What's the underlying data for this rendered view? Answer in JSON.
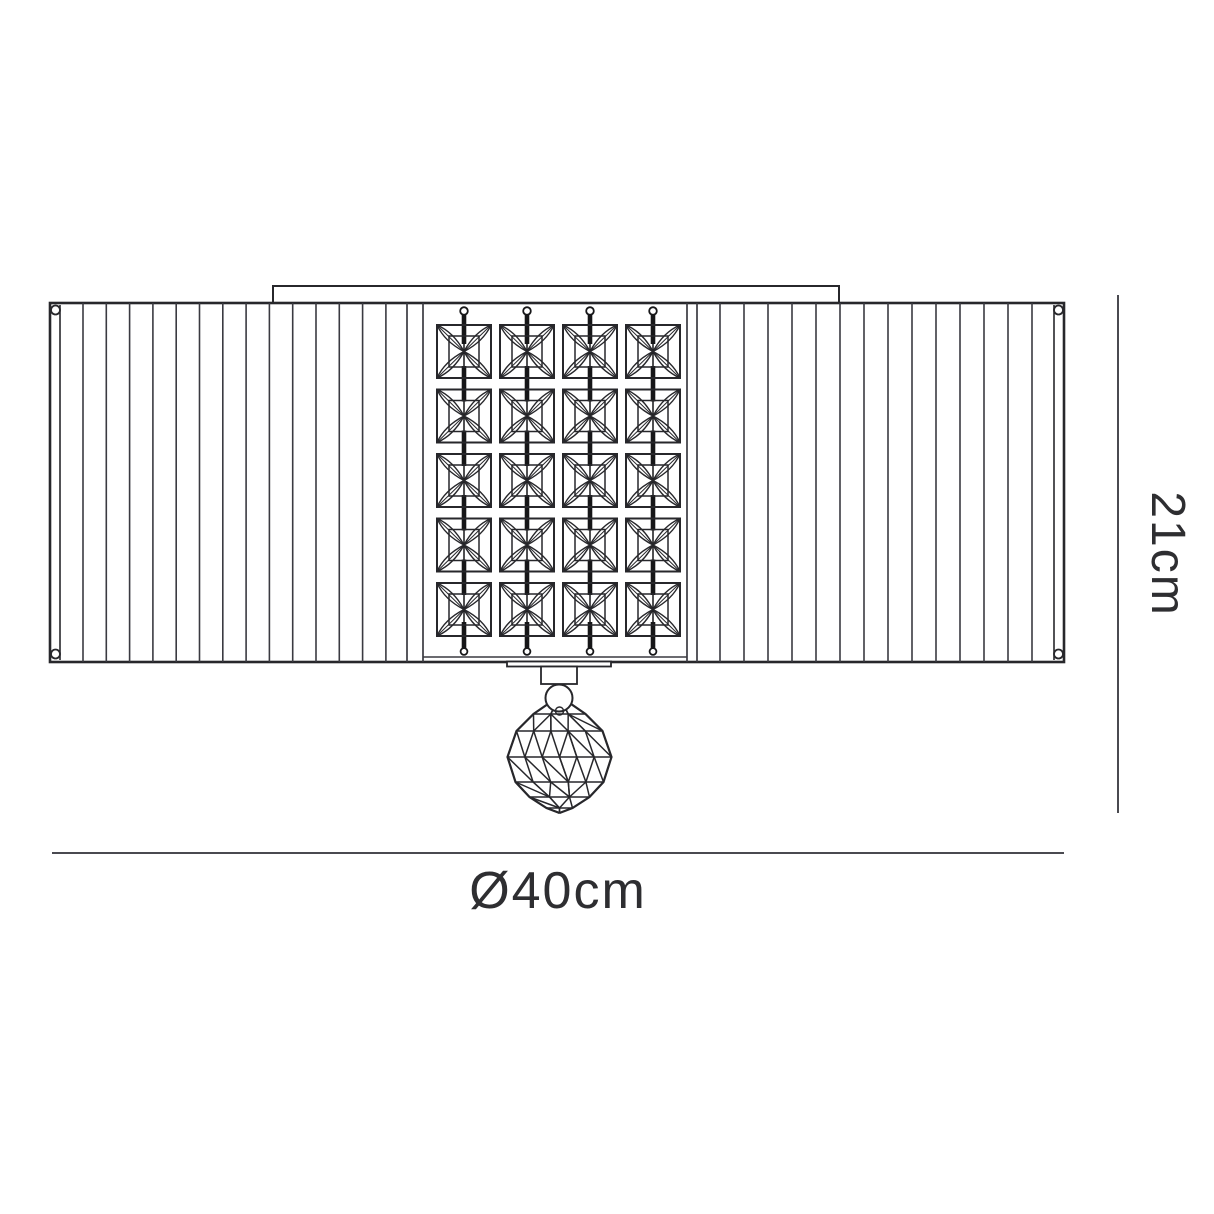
{
  "diagram": {
    "type": "product-dimension-drawing",
    "description": "Line drawing of a flush-mount ceiling light: pleated rectangular shade with a central panel of square crystals hung on chains and a faceted crystal ball finial below",
    "dimensions": {
      "height": "21cm",
      "diameter": "Ø40cm"
    },
    "crystal_grid": {
      "columns": 4,
      "rows": 5
    },
    "pleats_per_side": 14,
    "colors": {
      "background": "#ffffff",
      "ink": "#27272b",
      "pleat_ink": "#3a3a41",
      "chain_ink": "#161618",
      "dim_line": "#4a4a50",
      "text": "#2e2e31"
    }
  }
}
